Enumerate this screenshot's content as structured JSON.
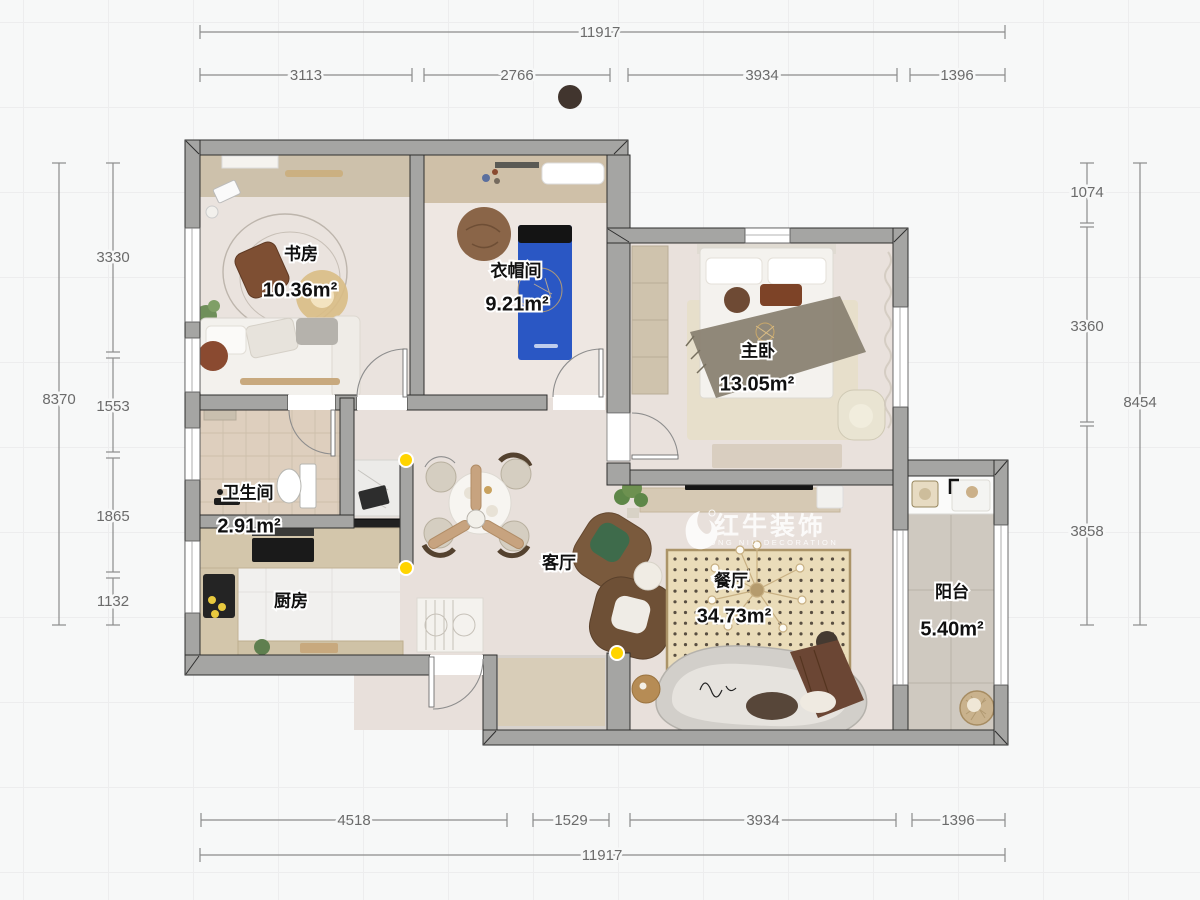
{
  "watermark": {
    "brand": "红牛装饰",
    "subtitle": "HONG NIU DECORATION"
  },
  "rooms": {
    "study": {
      "name": "书房",
      "area": "10.36m²"
    },
    "cloakroom": {
      "name": "衣帽间",
      "area": "9.21m²"
    },
    "master_bedroom": {
      "name": "主卧",
      "area": "13.05m²"
    },
    "bathroom": {
      "name": "卫生间",
      "area": "2.91m²"
    },
    "kitchen": {
      "name": "厨房"
    },
    "living_room": {
      "name": "客厅"
    },
    "dining_room": {
      "name": "餐厅",
      "area": "34.73m²"
    },
    "balcony": {
      "name": "阳台",
      "area": "5.40m²"
    }
  },
  "dimensions": {
    "top": {
      "total": "11917",
      "segments": [
        "3113",
        "2766",
        "3934",
        "1396"
      ]
    },
    "bottom": {
      "total": "11917",
      "segments": [
        "4518",
        "1529",
        "3934",
        "1396"
      ]
    },
    "left": {
      "total": "8370",
      "segments": [
        "3330",
        "1553",
        "1865",
        "1132"
      ]
    },
    "right": {
      "total": "8454",
      "segments": [
        "1074",
        "3360",
        "3858"
      ]
    }
  },
  "colors": {
    "wall": "#a5a5a3",
    "floor_main": "#e8e0db",
    "marker_yellow": "#ffd400",
    "mat_dining": "#eadcb9",
    "cabinet_tan": "#cdc1ab"
  }
}
